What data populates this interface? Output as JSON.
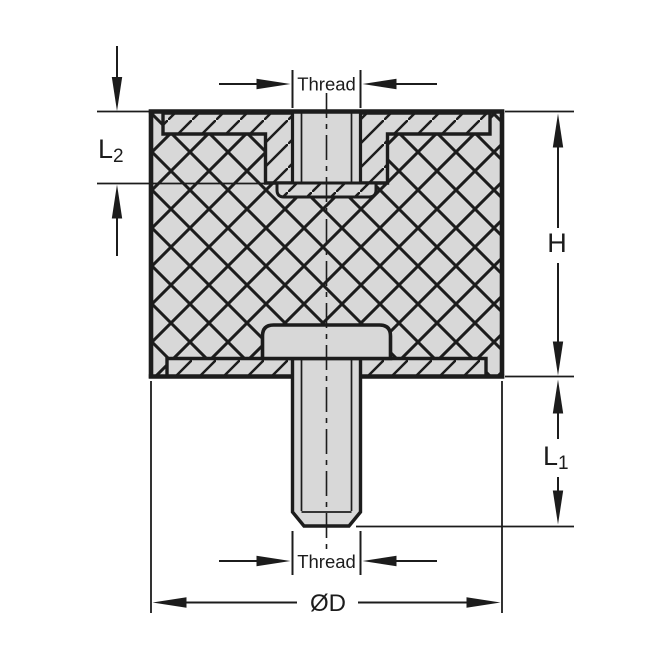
{
  "diagram": {
    "description": "Engineering cross-section drawing of a cylindrical rubber anti-vibration bobbin mount with a female threaded insert recessed in the top face and a male threaded stud protruding from the bottom plate",
    "colors": {
      "background": "#ffffff",
      "line": "#1c1c1c",
      "fill": "#d8d8d8"
    },
    "labels": {
      "thread_top": "Thread",
      "thread_bottom": "Thread",
      "diameter": "ØD",
      "height": "H",
      "l1_main": "L",
      "l1_sub": "1",
      "l2_main": "L",
      "l2_sub": "2"
    }
  }
}
